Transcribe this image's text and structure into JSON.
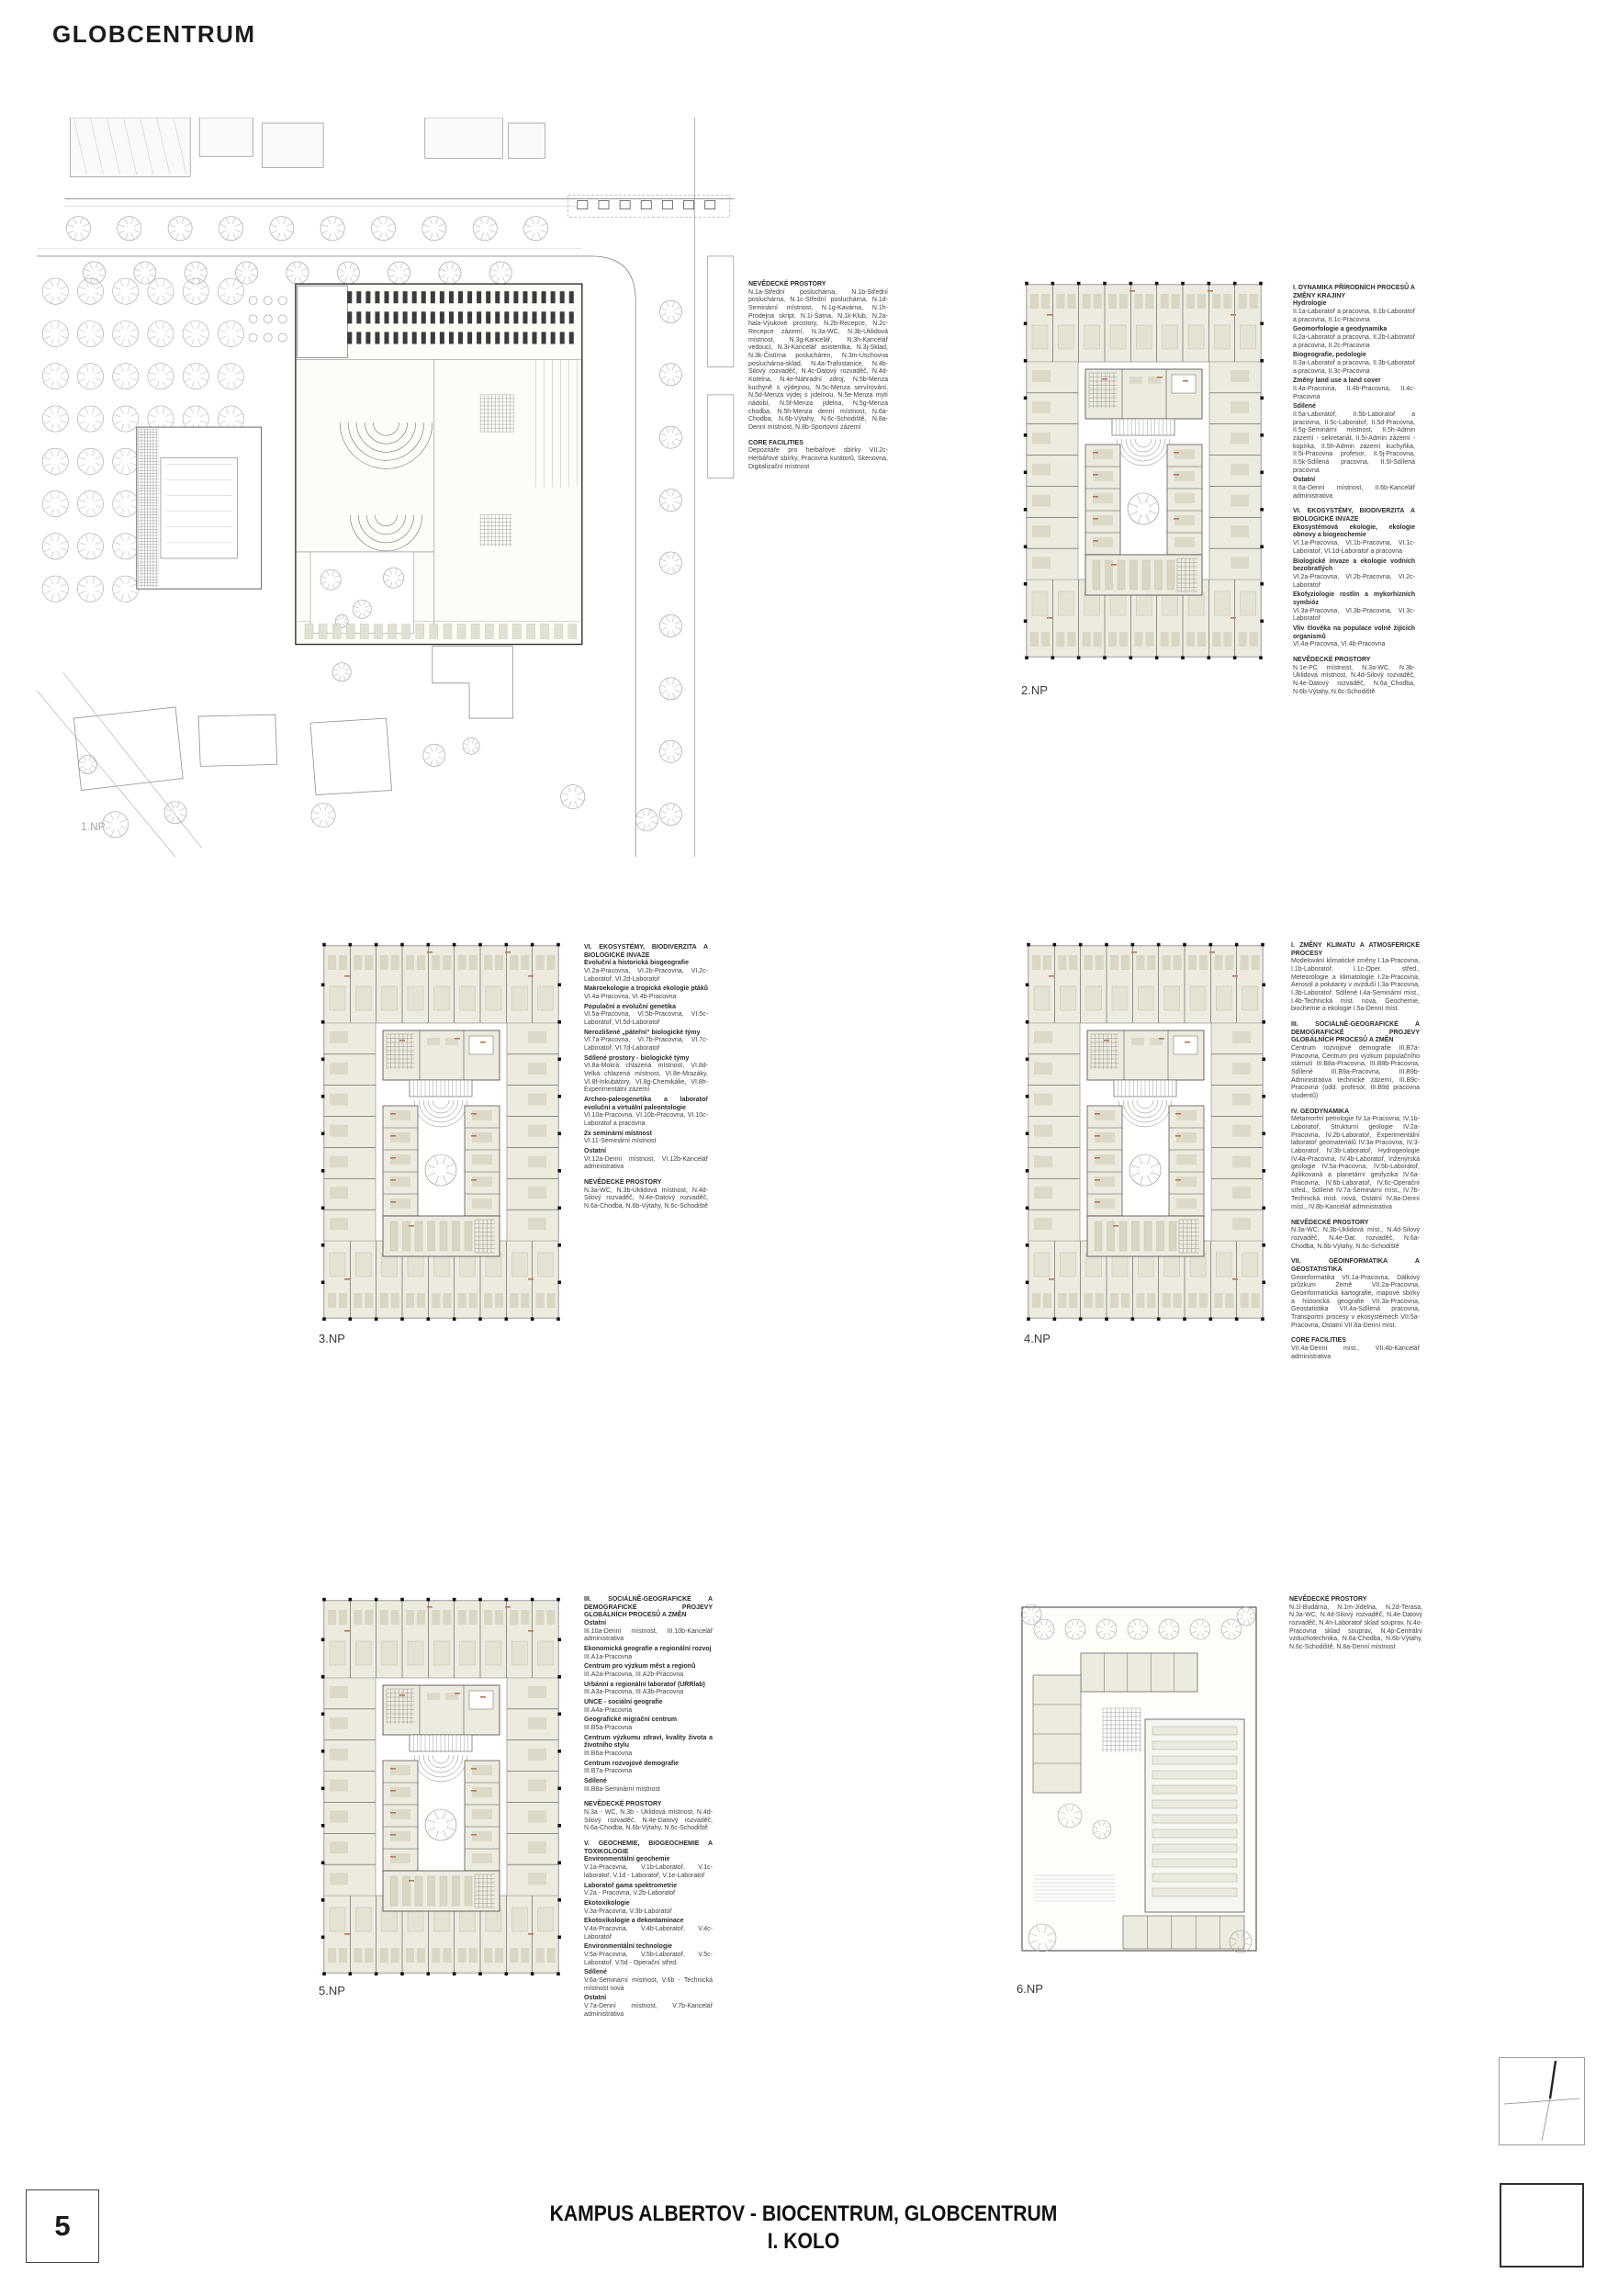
{
  "page": {
    "title": "GLOBCENTRUM"
  },
  "footer": {
    "sheet_number": "5",
    "title_line1": "KAMPUS ALBERTOV - BIOCENTRUM, GLOBCENTRUM",
    "title_line2": "I. KOLO"
  },
  "colors": {
    "room_fill": "#edebdf",
    "column_ink": "#111111",
    "room_code_ink": "#b57a52"
  },
  "plans": {
    "np1": {
      "label": "1.NP",
      "sections": [
        {
          "h": "NEVĚDECKÉ PROSTORY",
          "b": "N.1a-Střední posluchárna, N.1b-Střední posluchárna, N.1c-Střední posluchárna, N.1d-Seminární místnost, N.1g-Kavárna, N.1h-Prodejna skript, N.1i-Šatna, N.1k-Klub, N.2a-hala-Výukové prostory, N.2b-Recepce, N.2c-Recepce zázemí, N.3a-WC, N.3b-Úklidová místnost, N.3g-Kancelář, N.3h-Kancelář vedoucí, N.3i-Kancelář asistentka, N.3j-Sklad, N.3k-Čistírna poslucháren, N.3m-Úschovna posluchárna-sklad, N.4a-Trafostanice, N.4b-Silový rozvaděč, N.4c-Datový rozvaděč, N.4d-Kotelna, N.4e-Náhradní zdroj, N.5b-Menza kuchyně s výdejnou, N.5c-Menza servírování, N.5d-Menza výdej s jídelnou, N.5e-Menza mytí nádobí, N.5f-Menza jídelna, N.5g-Menza chodba, N.5h-Menza denní místnost, N.6a-Chodba, N.6b-Výtahy, N.6c-Schodiště, N.8a-Denní místnost, N.8b-Sportovní zázemí"
        },
        {
          "h": "CORE FACILITIES",
          "b": "Depozitáře pro herbářové sbírky VII.2c-Herbářové sbírky, Pracovna kurátorů, Skenovna, Digitalizační místnost"
        }
      ]
    },
    "np2": {
      "label": "2.NP",
      "sections": [
        {
          "h": "I. DYNAMIKA PŘÍRODNÍCH PROCESŮ A ZMĚNY KRAJINY",
          "blocks": [
            {
              "h": "Hydrologie",
              "b": "II.1a-Laboratoř a pracovna, II.1b-Laboratoř a pracovna, II.1c-Pracovna"
            },
            {
              "h": "Geomorfologie a geodynamika",
              "b": "II.2a-Laboratoř a pracovna, II.2b-Laboratoř a pracovna, II.2c-Pracovna"
            },
            {
              "h": "Biogeografie, pedologie",
              "b": "II.3a-Laboratoř a pracovna, II.3b-Laboratoř a pracovna, II.3c-Pracovna"
            },
            {
              "h": "Změny land use a land cover",
              "b": "II.4a-Pracovna, II.4b-Pracovna, II.4c-Pracovna"
            },
            {
              "h": "Sdílené",
              "b": "II.5a-Laboratoř, II.5b-Laboratoř a pracovna, II.5c-Laboratoř, II.5d-Pracovna, II.5g-Seminární místnost, II.5h-Admin zázemí - sekretariát, II.5i-Admin zázemí - kopírka, II.5h-Admin zázemí kuchyňka, II.5i-Pracovna profesor, II.5j-Pracovna, II.5k-Sdílená pracovna, II.5l-Sdílená pracovna"
            },
            {
              "h": "Ostatní",
              "b": "II.6a-Denní místnost, II.6b-Kancelář administrativa"
            }
          ]
        },
        {
          "h": "VI. EKOSYSTÉMY, BIODIVERZITA A BIOLOGICKÉ INVAZE",
          "blocks": [
            {
              "h": "Ekosystémová ekologie, ekologie obnovy a biogeochemie",
              "b": "VI.1a-Pracovna, VI.1b-Pracovna, VI.1c-Laboratoř, VI.1d-Laboratoř a pracovna"
            },
            {
              "h": "Biologické invaze a ekologie vodních bezobratlých",
              "b": "VI.2a-Pracovna, VI.2b-Pracovna, VI.2c-Laboratoř"
            },
            {
              "h": "Ekofyziologie rostlin a mykorhizních symbióz",
              "b": "VI.3a-Pracovna, VI.3b-Pracovna, VI.3c-Laboratoř"
            },
            {
              "h": "Vliv člověka na populace volně žijících organismů",
              "b": "VI.4a-Pracovna, VI.4b-Pracovna"
            }
          ]
        },
        {
          "h": "NEVĚDECKÉ PROSTORY",
          "b": "N.1e-PC místnost, N.3a-WC, N.3b-Úklidová místnost, N.4d-Silový rozvaděč, N.4e-Datový rozvaděč, N.6a_Chodba, N.6b-Výtahy, N.6c-Schodiště"
        }
      ]
    },
    "np3": {
      "label": "3.NP",
      "sections": [
        {
          "h": "VI. EKOSYSTÉMY, BIODIVERZITA A BIOLOGICKÉ INVAZE",
          "blocks": [
            {
              "h": "Evoluční a historická biogeografie",
              "b": "VI.2a-Pracovna, VI.2b-Pracovna, VI.2c-Laboratoř, VI.2d-Laboratoř"
            },
            {
              "h": "Makroekologie a tropická ekologie ptáků",
              "b": "VI.4a-Pracovna, VI.4b-Pracovna"
            },
            {
              "h": "Populační a evoluční genetika",
              "b": "VI.5a-Pracovna, VI.5b-Pracovna, VI.5c-Laboratoř, VI.5d-Laboratoř"
            },
            {
              "h": "Nerozlišené „páteřní“ biologické týmy",
              "b": "VI.7a-Pracovna, VI.7b-Pracovna, VI.7c-Laboratoř, VI.7d-Laboratoř"
            },
            {
              "h": "Sdílené prostory - biologické týmy",
              "b": "VI.8a-Mokrá chlazená místnost, VI.8d-Velká chlazená místnost, VI.8e-Mrazáky, VI.8f-Inkubátory, VI.8g-Chemikálie, VI.8h-Experimentální zázemí"
            },
            {
              "h": "Archeo-paleogenetika a laboratoř evoluční a virtuální paleontologie",
              "b": "VI.10a-Pracovna, VI.10b-Pracovna, VI.10c-Laboratoř a pracovna"
            },
            {
              "h": "2x seminární místnost",
              "b": "VI.11-Seminární místnost"
            },
            {
              "h": "Ostatní",
              "b": "VI.12a-Denní místnost, VI.12b-Kancelář administrativa"
            }
          ]
        },
        {
          "h": "NEVĚDECKÉ PROSTORY",
          "b": "N.3a-WC, N.3b-Úklidová místnost, N.4d-Silový rozvaděč, N.4e-Datový rozvaděč, N.6a-Chodba, N.6b-Výtahy, N.6c-Schodiště"
        }
      ]
    },
    "np4": {
      "label": "4.NP",
      "sections": [
        {
          "h": "I. ZMĚNY KLIMATU A ATMOSFÉRICKÉ PROCESY",
          "b": "Modelování klimatické změny I.1a-Pracovna, I.1b-Laboratoř, I.1c-Oper. střed., Meteorologie a klimatologie I.2a-Pracovna, Aerosol a polutanty v ovzduší I.3a-Pracovna, I.3b-Laboratoř, Sdílené I.4a-Seminární míst., I.4b-Technická míst. nová, Geochemie, biochemie a ekologie I.5a-Denní míst."
        },
        {
          "h": "III. SOCIÁLNĚ-GEOGRAFICKÉ A DEMOGRAFICKÉ PROJEVY GLOBÁLNÍCH PROCESŮ A ZMĚN",
          "b": "Centrum rozvojové demografie III.B7a-Pracovna, Centrum pro výzkum populačního stárnutí III.B8a-Pracovna, III.B8b-Pracovna, Sdílené III.B9a-Pracovna, III.B9b-Administrativa technické zázemí, III.B9c-Pracovna (odd. profesor, III.B9d pracovna studentů)"
        },
        {
          "h": "IV. GEODYNAMIKA",
          "b": "Metamorfní petrologie IV.1a-Pracovna, IV.1b-Laboratoř, Strukturní geologie IV.2a-Pracovna, IV.2b-Laboratoř, Experimentální laboratoř geomateriálů IV.3a-Pracovna, IV.3-Laboratoř, IV.3b-Laboratoř, Hydrogeologie IV.4a-Pracovna, IV.4b-Laboratoř, Inženýrská geologie IV.5a-Pracovna, IV.5b-Laboratoř, Aplikovaná a planetární geofyzika IV.6a-Pracovna, IV.6b-Laboratoř, IV.6c-Operační střed., Sdílené IV.7a-Seminární míst., IV.7b-Technická míst. nová, Ostatní IV.8a-Denní míst., IV.8b-Kancelář administrativa"
        },
        {
          "h": "NEVĚDECKÉ PROSTORY",
          "b": "N.3a-WC, N.3b-Úklidová míst., N.4d-Silový rozvaděč, N.4e-Dat. rozvaděč, N.6a-Chodba, N.6b-Výtahy, N.6c-Schodiště"
        },
        {
          "h": "VII. GEOINFORMATIKA A GEOSTATISTIKA",
          "b": "Geoinformatika VII.1a-Pracovna, Dálkový průzkum Země VII.2a-Pracovna, Geoinformatická kartografie, mapové sbírky a historická geografie VII.3a-Pracovna, Geostatistika VII.4a-Sdílená pracovna, Transportní procesy v ekosystémech VII.5a-Pracovna, Ostatní VII.6a-Denní míst."
        },
        {
          "h": "CORE FACILITIES",
          "b": "VII.4a-Denní míst., VII.4b-Kancelář administrativa"
        }
      ]
    },
    "np5": {
      "label": "5.NP",
      "sections": [
        {
          "h": "III. SOCIÁLNĚ-GEOGRAFICKÉ A DEMOGRAFICKÉ PROJEVY GLOBÁLNÍCH PROCESŮ A ZMĚN",
          "blocks": [
            {
              "h": "Ostatní",
              "b": "III.10a-Denní místnost, III.10b-Kancelář administrativa"
            },
            {
              "h": "Ekonomická geografie a regionální rozvoj",
              "b": "III.A1a-Pracovna"
            },
            {
              "h": "Centrum pro výzkum měst a regionů",
              "b": "III.A2a-Pracovna, III.A2b-Pracovna"
            },
            {
              "h": "Urbánní a regionální laboratoř (URRlab)",
              "b": "III.A3a-Pracovna, III.A3b-Pracovna"
            },
            {
              "h": "UNCE - sociální geografie",
              "b": "III.A4a-Pracovna"
            },
            {
              "h": "Geografické migrační centrum",
              "b": "III.B5a-Pracovna"
            },
            {
              "h": "Centrum výzkumu zdraví, kvality života a životního stylu",
              "b": "III.B6a-Pracovna"
            },
            {
              "h": "Centrum rozvojové demografie",
              "b": "III.B7a-Pracovna"
            },
            {
              "h": "Sdílené",
              "b": "III.B8a-Seminární místnost"
            }
          ]
        },
        {
          "h": "NEVĚDECKÉ PROSTORY",
          "b": "N.3a - WC, N.3b - Úklidová místnost, N.4d-Silový rozvaděč, N.4e-Datový rozvaděč, N.6a-Chodba, N.6b-Výtahy, N.6c-Schodiště"
        },
        {
          "h": "V. GEOCHEMIE, BIOGEOCHEMIE A TOXIKOLOGIE",
          "blocks": [
            {
              "h": "Environmentální geochemie",
              "b": "V.1a-Pracovna, V.1b-Laboratoř, V.1c-laboratoř, V.1d - Laboratoř, V.1e-Laboratoř"
            },
            {
              "h": "Laboratoř gama spektrometrie",
              "b": "V.2a - Pracovna, V.2b-Laboratoř"
            },
            {
              "h": "Ekotoxikologie",
              "b": "V.3a-Pracovna, V.3b-Laboratoř"
            },
            {
              "h": "Ekotoxikologie a dekontaminace",
              "b": "V.4a-Pracovna, V.4b-Laboratoř, V.4c-Laboratoř"
            },
            {
              "h": "Environmentální technologie",
              "b": "V.5a-Pracovna, V.5b-Laboratoř, V.5c-Laboratoř, V.5d - Operační střed."
            },
            {
              "h": "Sdílené",
              "b": "V.6a-Seminární místnost, V.6b - Technická místnost nová"
            },
            {
              "h": "Ostatní",
              "b": "V.7a-Denní místnost, V.7b-Kancelář administrativa"
            }
          ]
        }
      ]
    },
    "np6": {
      "label": "6.NP",
      "sections": [
        {
          "h": "NEVĚDECKÉ PROSTORY",
          "b": "N.1l-Budárna, N.1m-Jídelna, N.2d-Terasa, N.3a-WC, N.4d-Silový rozvaděč, N.4e-Datový rozvaděč, N.4n-Laboratoř sklad souprav, N.4o-Pracovna sklad souprav, N.4p-Centrální vzduchotechnika, N.6a-Chodba, N.6b-Výtahy, N.6c-Schodiště, N.8a-Denní místnost"
        }
      ]
    }
  }
}
